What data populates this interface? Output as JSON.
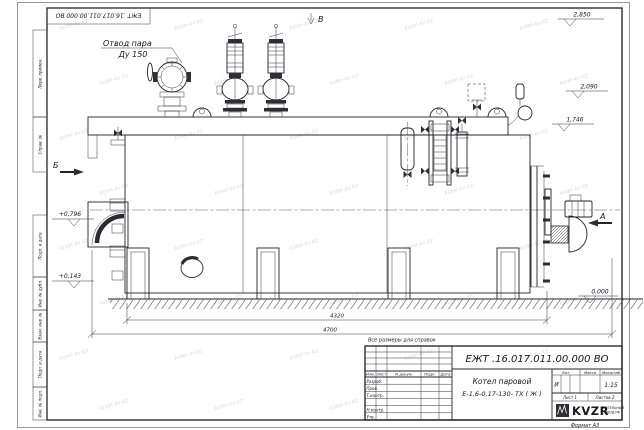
{
  "sheet": {
    "stamp_top": "ЕЖТ .16.017.011.00.000  ВО",
    "format_label": "Формат А3",
    "margin_labels": [
      "Перв. примен.",
      "Справ. №",
      "Подп. и дата",
      "Инв. № дубл.",
      "Взам. инв. №",
      "Подп. и дата",
      "Инв. № подл."
    ]
  },
  "drawing": {
    "steam_outlet": {
      "line1": "Отвод пара",
      "line2": "Ду 150"
    },
    "views": {
      "b_top": "В",
      "b_side": "Б",
      "a_right": "А"
    },
    "elevations": {
      "top": "2,850",
      "upper_mid": "2,090",
      "lower_mid": "1,746",
      "zero": "0,000",
      "left_upper": "+0,796",
      "left_lower": "+0,143"
    },
    "dimensions": {
      "length_main": "4320",
      "length_overall": "4700"
    },
    "note": "Все размеры для справок"
  },
  "title_block": {
    "doc_number": "ЕЖТ .16.017.011.00.000  ВО",
    "product_name_line1": "Котел паровой",
    "product_name_line2": "Е-1,6-0,17-130- ТХ ( Ж )",
    "columns": {
      "izm": "Изм.",
      "list": "Лист",
      "doc": "N докум.",
      "sign": "Подп.",
      "date": "Дата"
    },
    "rows": [
      "Разраб.",
      "Пров.",
      "Т.контр.",
      "",
      "Н.контр.",
      "Утв."
    ],
    "lit_header": "Лит.",
    "mass_header": "Масса",
    "scale_header": "Масштаб",
    "lit_value": "И",
    "scale_value": "1:15",
    "sheet_label": "Лист 1",
    "sheets_label": "Листов 2",
    "logo_text": "KVZR",
    "logo_sub1": "КОТЕЛЬНЫЙ",
    "logo_sub2": "ЗАВОД РФ"
  },
  "watermark": {
    "text": "kotel-kv.kz"
  },
  "colors": {
    "paper": "#ffffff",
    "ink": "#23232a"
  }
}
